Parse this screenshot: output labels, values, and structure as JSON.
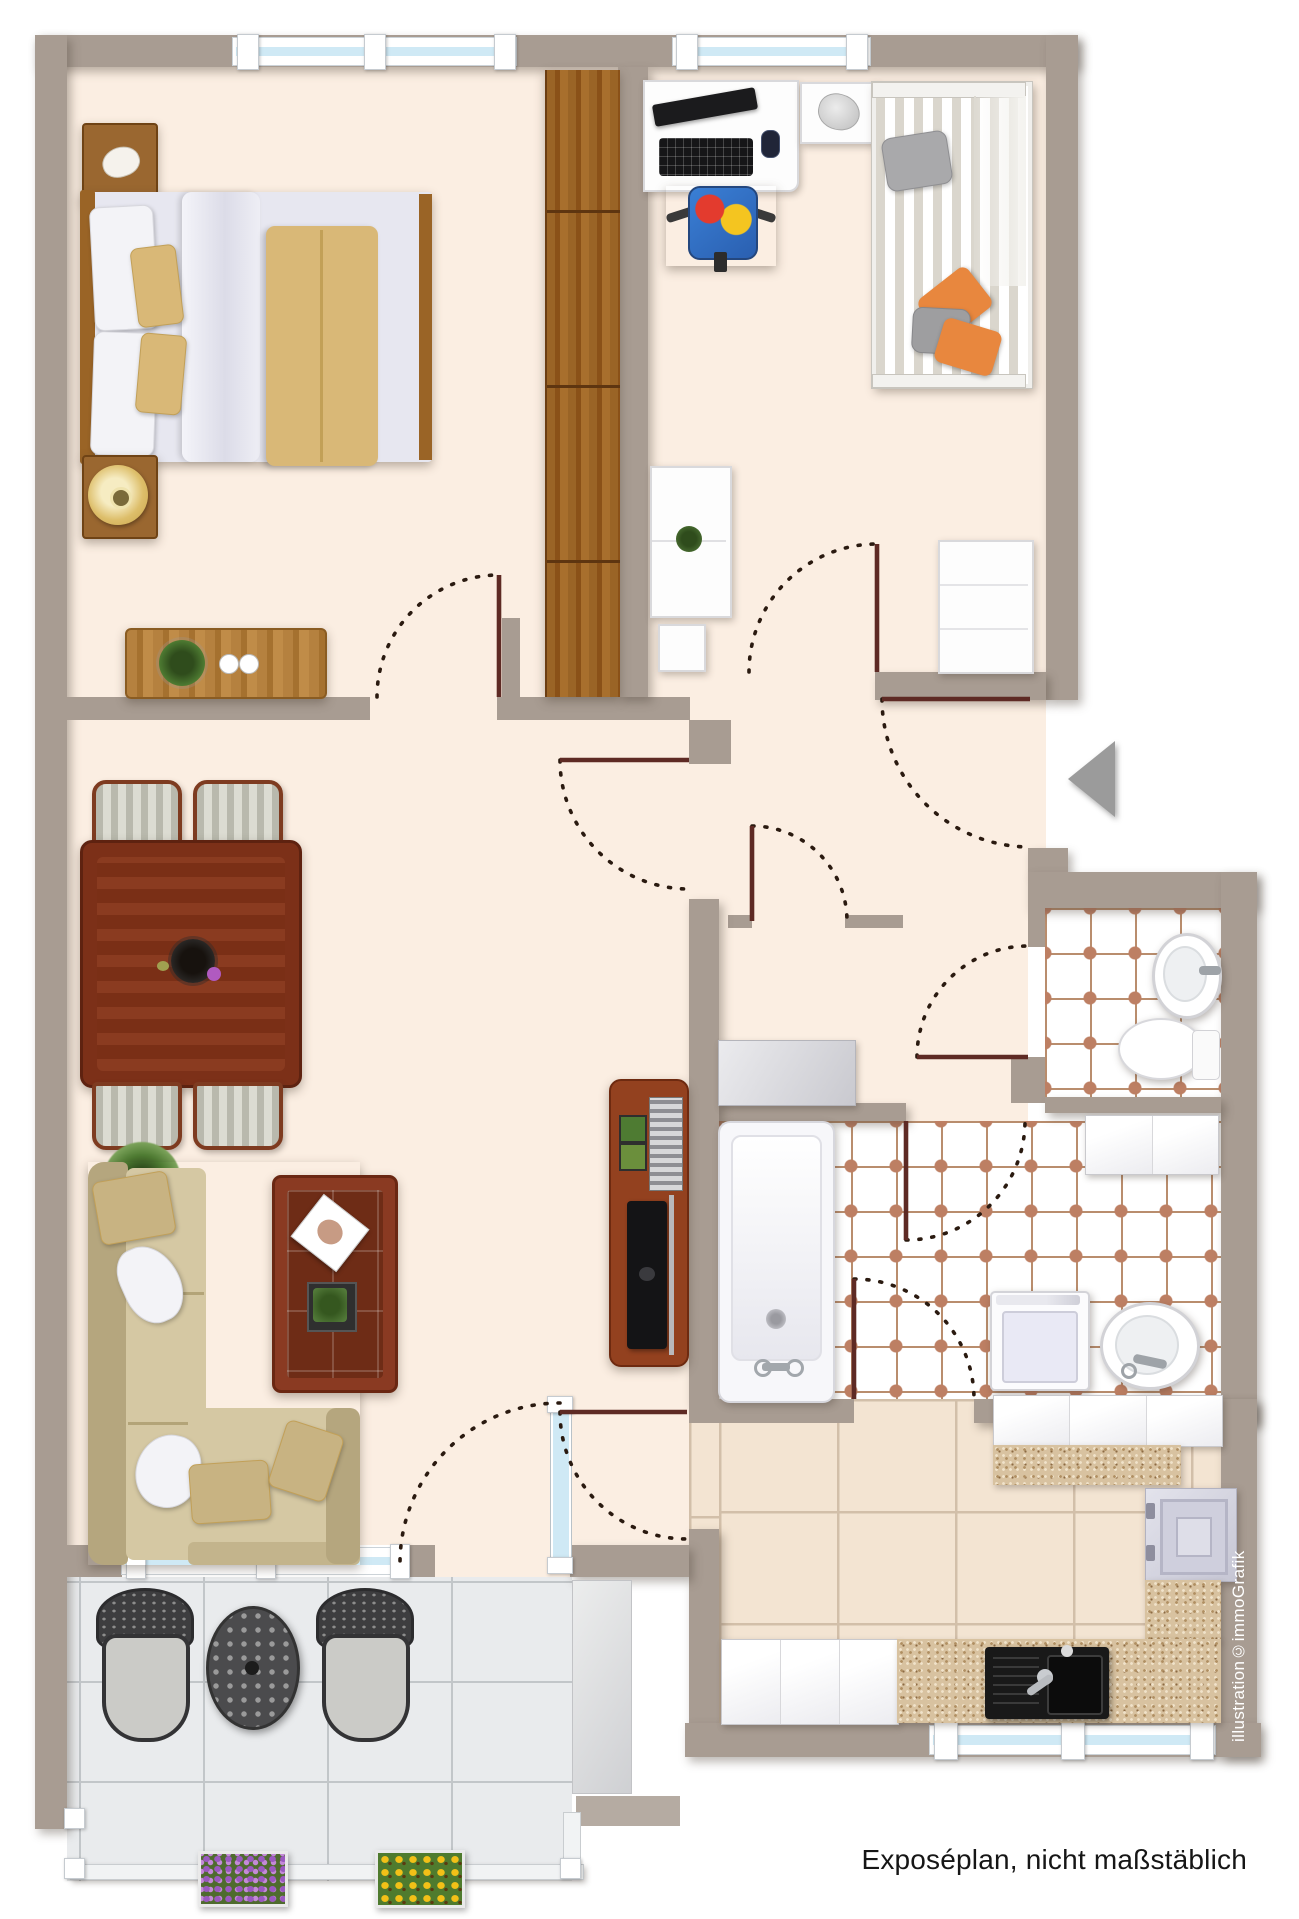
{
  "texts": {
    "credit_vertical": "illustration©immoGrafik",
    "caption": "Exposéplan, nicht maßstäblich"
  },
  "palette": {
    "wall": "#a89c92",
    "floorCream": "#fbeee2",
    "kitchenTile": "#f3e4d2",
    "kitchenLine": "#d2bfa9",
    "bathLine": "#b98d6d",
    "bathAccent": "#bd7f63",
    "marble": "#e9ebed",
    "marbleLine": "#c2c6c9",
    "glass": "#cfe9f5",
    "doorLine": "#5e2a24",
    "dashLine": "#2a1a10",
    "arrowGray": "#9b9b9b",
    "tan": "#d9b877",
    "duvet": "#e7e7f0",
    "woodDark": "#7c3018"
  }
}
